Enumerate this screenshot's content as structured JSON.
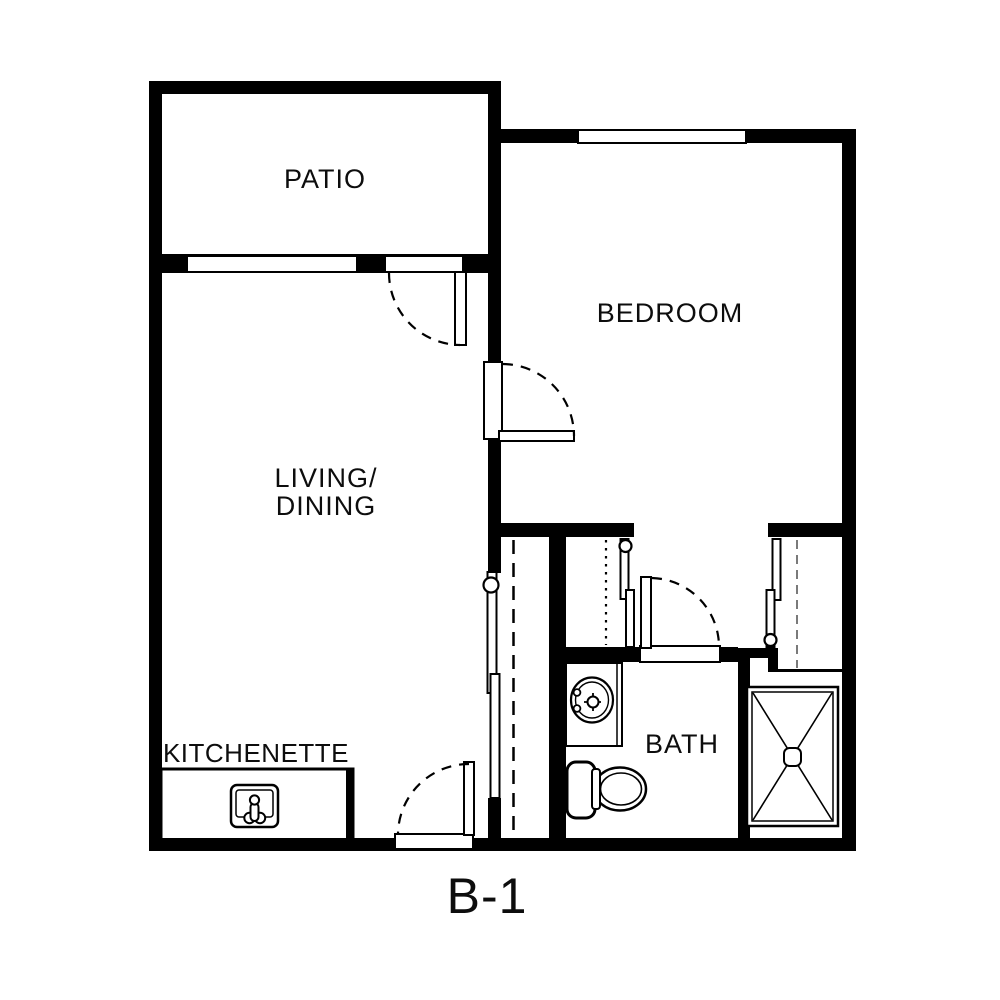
{
  "floorplan": {
    "unit_label": "B-1",
    "rooms": {
      "patio": {
        "label": "PATIO"
      },
      "bedroom": {
        "label": "BEDROOM"
      },
      "living_dining": {
        "label_line1": "LIVING/",
        "label_line2": "DINING"
      },
      "kitchenette": {
        "label": "KITCHENETTE"
      },
      "bath": {
        "label": "BATH"
      }
    },
    "fixtures": {
      "kitchen_sink": "kitchen-sink-icon",
      "bathroom_sink": "bathroom-sink-icon",
      "toilet": "toilet-icon",
      "shower": "shower-icon"
    },
    "colors": {
      "wall": "#000000",
      "background": "#ffffff",
      "closet_rod_gray": "#7a7a7a"
    }
  }
}
